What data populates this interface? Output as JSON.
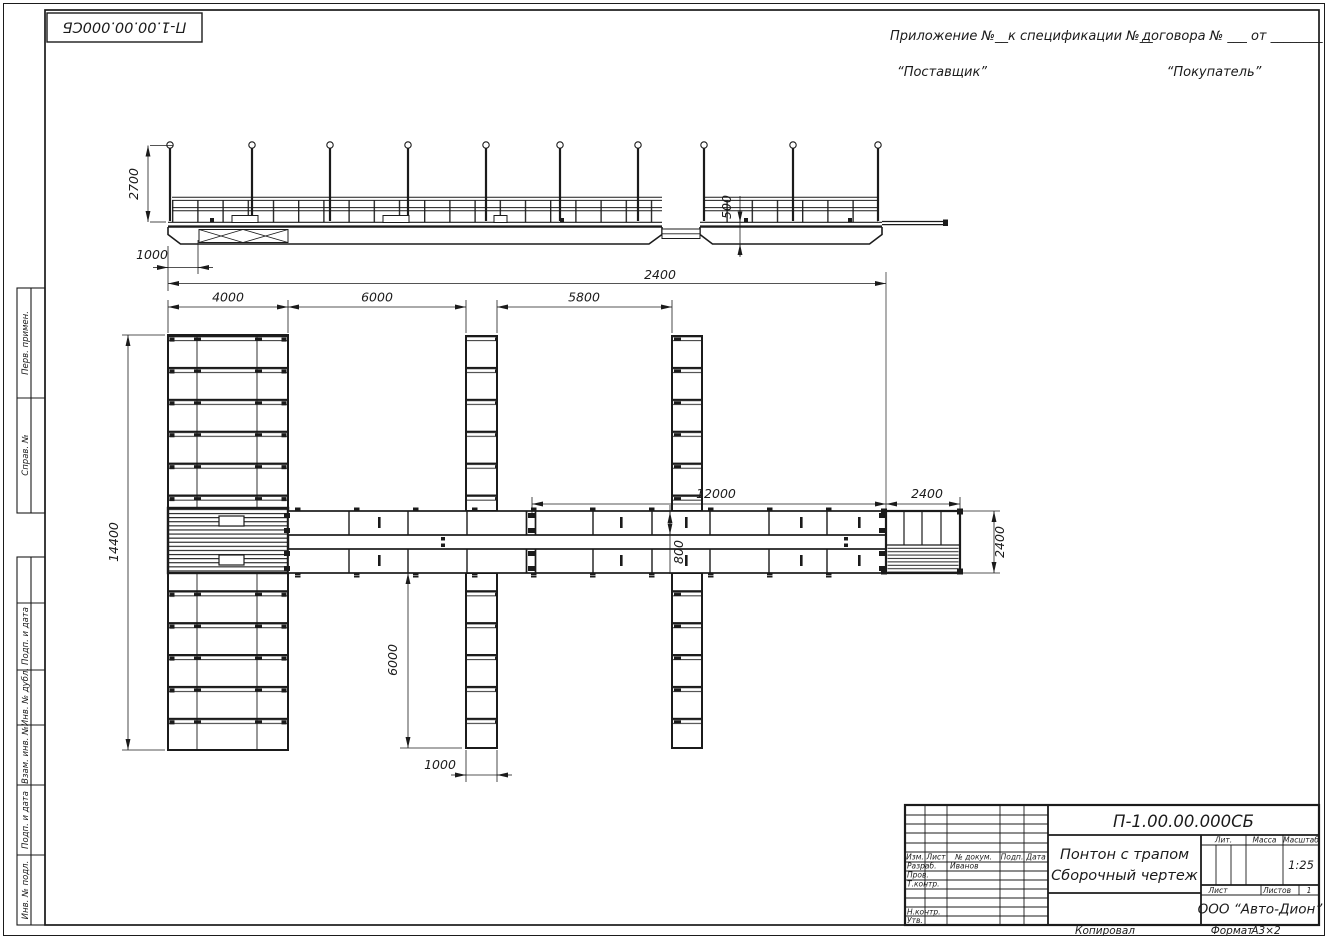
{
  "sheet": {
    "corner_doc_number": "П-1.00.00.000СБ",
    "appendix": {
      "part1": "Приложение №__",
      "part2": "к спецификации №__",
      "part3": "договора № ___  от ________"
    },
    "supplier": "“Поставщик”",
    "buyer": "“Покупатель”"
  },
  "margin_stamps": {
    "perv_primen": "Перв. примен.",
    "sprav_no": "Справ. №",
    "podp_data_1": "Подп. и дата",
    "inv_dubl": "Инв. № дубл.",
    "vzam_inv": "Взам. инв. №",
    "podp_data_2": "Подп. и дата",
    "inv_podl": "Инв. № подл."
  },
  "dims": {
    "post_height": "2700",
    "left_offset": "1000",
    "pontoon_length": "2400",
    "freeboard": "500",
    "finger_width_top": "4000",
    "gap_left": "6000",
    "gap_right": "5800",
    "walkway_length": "12000",
    "platform_length": "2400",
    "overall_width": "14400",
    "walkway_width": "800",
    "finger_length_bottom": "6000",
    "finger_width_bottom": "1000",
    "platform_width": "2400"
  },
  "title_block": {
    "doc_number": "П-1.00.00.000СБ",
    "name_line1": "Понтон с трапом",
    "name_line2": "Сборочный чертеж",
    "col_izm": "Изм.",
    "col_list": "Лист",
    "col_dokum": "№ докум.",
    "col_podp": "Подп.",
    "col_data": "Дата",
    "row_razrab": "Разраб.",
    "razrab_name": "Иванов",
    "row_prov": "Пров.",
    "row_tkontr": "Т.контр.",
    "row_nkontr": "Н.контр.",
    "row_utv": "Утв.",
    "lit_label": "Лит.",
    "massa_label": "Масса",
    "masshtab_label": "Масштаб",
    "masshtab_value": "1:25",
    "list_label": "Лист",
    "listov_label": "Листов",
    "listov_value": "1",
    "company": "ООО “Авто-Дион”"
  },
  "footer": {
    "copied_by": "Копировал",
    "format_label": "Формат",
    "format_value": "А3×2"
  }
}
